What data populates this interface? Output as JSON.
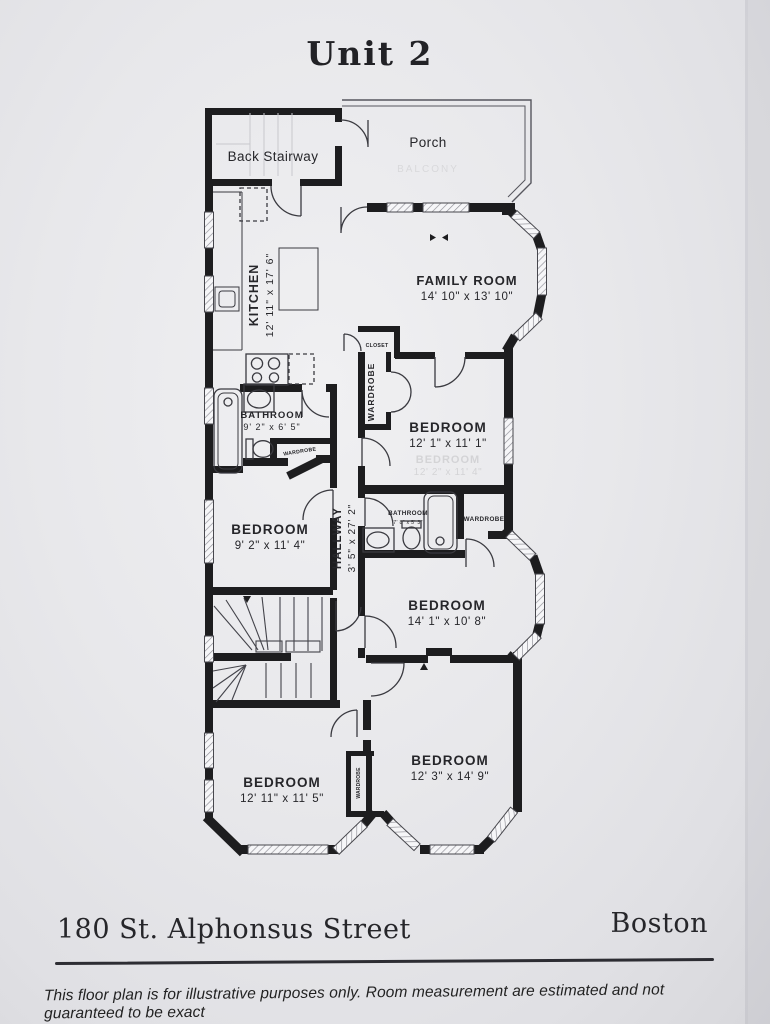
{
  "title": "Unit 2",
  "plan": {
    "back_stairway": "Back Stairway",
    "porch": "Porch",
    "kitchen": {
      "name": "KITCHEN",
      "dims": "12' 11\" x 17' 6\""
    },
    "family_room": {
      "name": "FAMILY ROOM",
      "dims": "14' 10\" x 13' 10\""
    },
    "closet": "CLOSET",
    "wardrobe_upper": "WARDROBE",
    "bedroom_right_upper": {
      "name": "BEDROOM",
      "dims": "12' 1\" x 11' 1\""
    },
    "bathroom_left": {
      "name": "BATHROOM",
      "dims": "9' 2\" x 6' 5\""
    },
    "wardrobe_bath_left": "WARDROBE",
    "bedroom_left_middle": {
      "name": "BEDROOM",
      "dims": "9' 2\" x 11' 4\""
    },
    "hallway": {
      "name": "HALLWAY",
      "dims": "3' 5\" x 27' 2\""
    },
    "bathroom_middle": {
      "name": "BATHROOM",
      "dims": "7' 8\" x 5' 3\""
    },
    "wardrobe_bath_middle": "WARDROBE",
    "bedroom_right_middle": {
      "name": "BEDROOM",
      "dims": "14' 1\" x 10' 8\""
    },
    "bedroom_right_lower": {
      "name": "BEDROOM",
      "dims": "12' 3\" x 14' 9\""
    },
    "bedroom_left_lower": {
      "name": "BEDROOM",
      "dims": "12' 11\" x 11' 5\""
    },
    "wardrobe_lower": "WARDROBE",
    "ghost": {
      "porch": "BALCONY",
      "bedroom_upper": "BEDROOM",
      "bedroom_upper_dims": "12' 2\" x 11' 4\""
    }
  },
  "footer": {
    "address": "180 St. Alphonsus Street",
    "city": "Boston",
    "disclaimer": "This floor plan is for illustrative purposes only.  Room measurement are estimated and not guaranteed to be exact"
  },
  "colors": {
    "paper": "#e8e8eb",
    "ink": "#1d1d1f",
    "text": "#26262a"
  }
}
